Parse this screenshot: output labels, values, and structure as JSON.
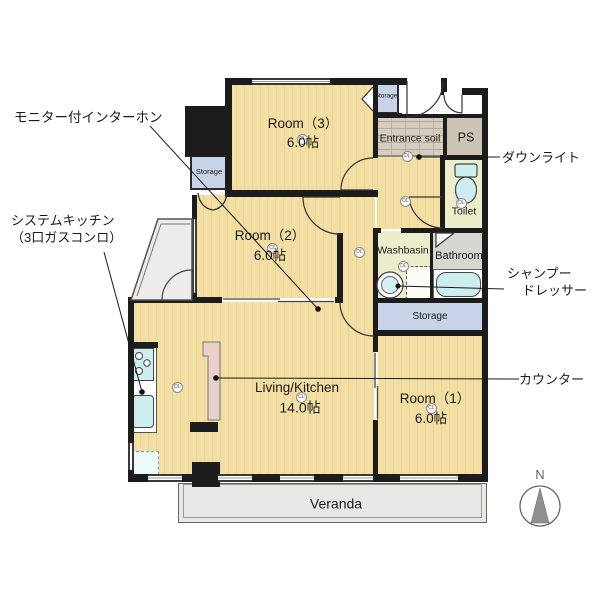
{
  "plan": {
    "rooms": {
      "room3": {
        "name": "Room（3）",
        "size": "6.0帖"
      },
      "room2": {
        "name": "Room（2）",
        "size": "6.0帖"
      },
      "room1": {
        "name": "Room（1）",
        "size": "6.0帖"
      },
      "living_kitchen": {
        "name": "Living/Kitchen",
        "size": "14.0帖"
      },
      "entrance": {
        "name": "Entrance soil"
      },
      "ps": {
        "name": "PS"
      },
      "toilet": {
        "name": "Toilet"
      },
      "washbasin": {
        "name": "Washbasin"
      },
      "bathroom": {
        "name": "Bathroom"
      },
      "storage_upper_left": {
        "name": "Storage"
      },
      "storage_entry": {
        "name": "Storage"
      },
      "storage_hall": {
        "name": "Storage"
      },
      "veranda": {
        "name": "Veranda"
      }
    },
    "annotations": {
      "intercom": "モニター付インターホン",
      "system_kitchen_line1": "システムキッチン",
      "system_kitchen_line2": "（3口ガスコンロ）",
      "downlight": "ダウンライト",
      "shampoo_dresser_line1": "シャンプー",
      "shampoo_dresser_line2": "ドレッサー",
      "counter": "カウンター"
    },
    "lights": {
      "ceiling": "CL",
      "down": "DL"
    },
    "compass": {
      "label": "N"
    },
    "colors": {
      "wood_floor": "#f3dfa3",
      "wet_floor": "#ebedcb",
      "bathroom_floor": "#d7d7d2",
      "storage_fill": "#c9d3e7",
      "fixture_cyan": "#cdeeee",
      "counter_pink": "#e9d1c9",
      "entrance_brick": "#d5cdbf",
      "ps_fill": "#ccc4b5",
      "veranda_fill": "#e7e7e5",
      "wall": "#1c1c1c"
    }
  }
}
